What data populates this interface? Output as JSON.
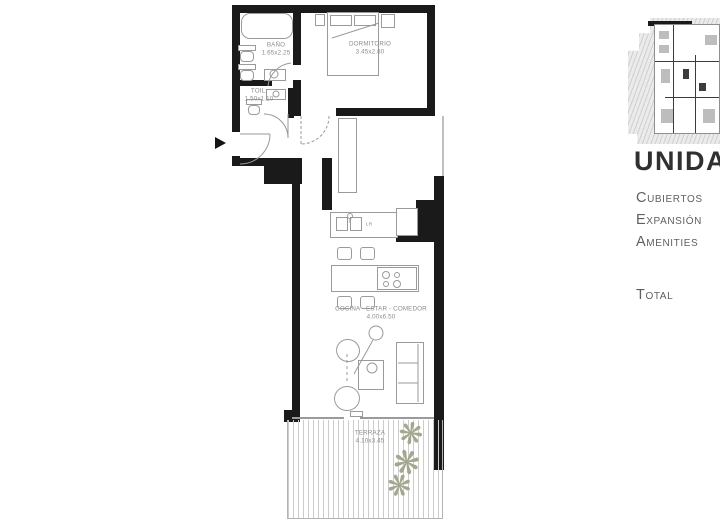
{
  "plan": {
    "rooms": [
      {
        "id": "bano",
        "name": "BAÑO",
        "dims": "1.65x2.25"
      },
      {
        "id": "toilette",
        "name": "TOIL.",
        "dims": "1.50x1.10"
      },
      {
        "id": "dormitorio",
        "name": "DORMITORIO",
        "dims": "3.45x2.80"
      },
      {
        "id": "cocina",
        "name": "COCINA - ESTAR - COMEDOR",
        "dims": "4.00x6.50"
      },
      {
        "id": "terraza",
        "name": "TERRAZA",
        "dims": "4.10x3.45"
      }
    ],
    "appliance_label": "LR"
  },
  "icons": {
    "plant": "❋"
  },
  "sidebar": {
    "title": "UNIDAD",
    "items": [
      {
        "label": "Cubiertos"
      },
      {
        "label": "Expansión"
      },
      {
        "label": "Amenities"
      }
    ],
    "total_label": "Total"
  },
  "colors": {
    "wall": "#1a1a1a",
    "furniture_line": "#9a9a9a",
    "label_text": "#8c8c8c",
    "deck_line": "#cccccc",
    "plant": "#a2a88e",
    "title_text": "#303030",
    "sidebar_text": "#5f5f5f"
  }
}
